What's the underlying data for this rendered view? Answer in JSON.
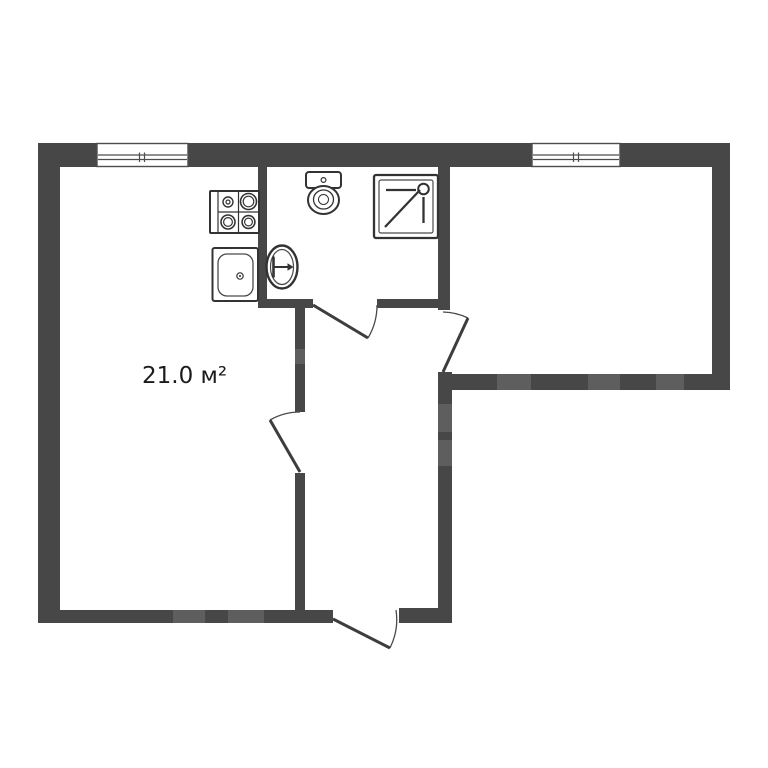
{
  "floor_plan": {
    "type": "apartment-floor-plan",
    "room_label": {
      "area": "21.0 м²"
    },
    "colors": {
      "wall": "#474747",
      "wall_light_patch": "#5e5e5e",
      "fixture_outline": "#333333",
      "thin_line": "#555555",
      "background": "#ffffff",
      "label_text": "#1b1b1b"
    },
    "counts": {
      "windows": 2,
      "doors": 4
    },
    "fixtures": [
      "stove-icon",
      "kitchen-sink-icon",
      "toilet-icon",
      "washbasin-icon",
      "shower-icon"
    ]
  }
}
